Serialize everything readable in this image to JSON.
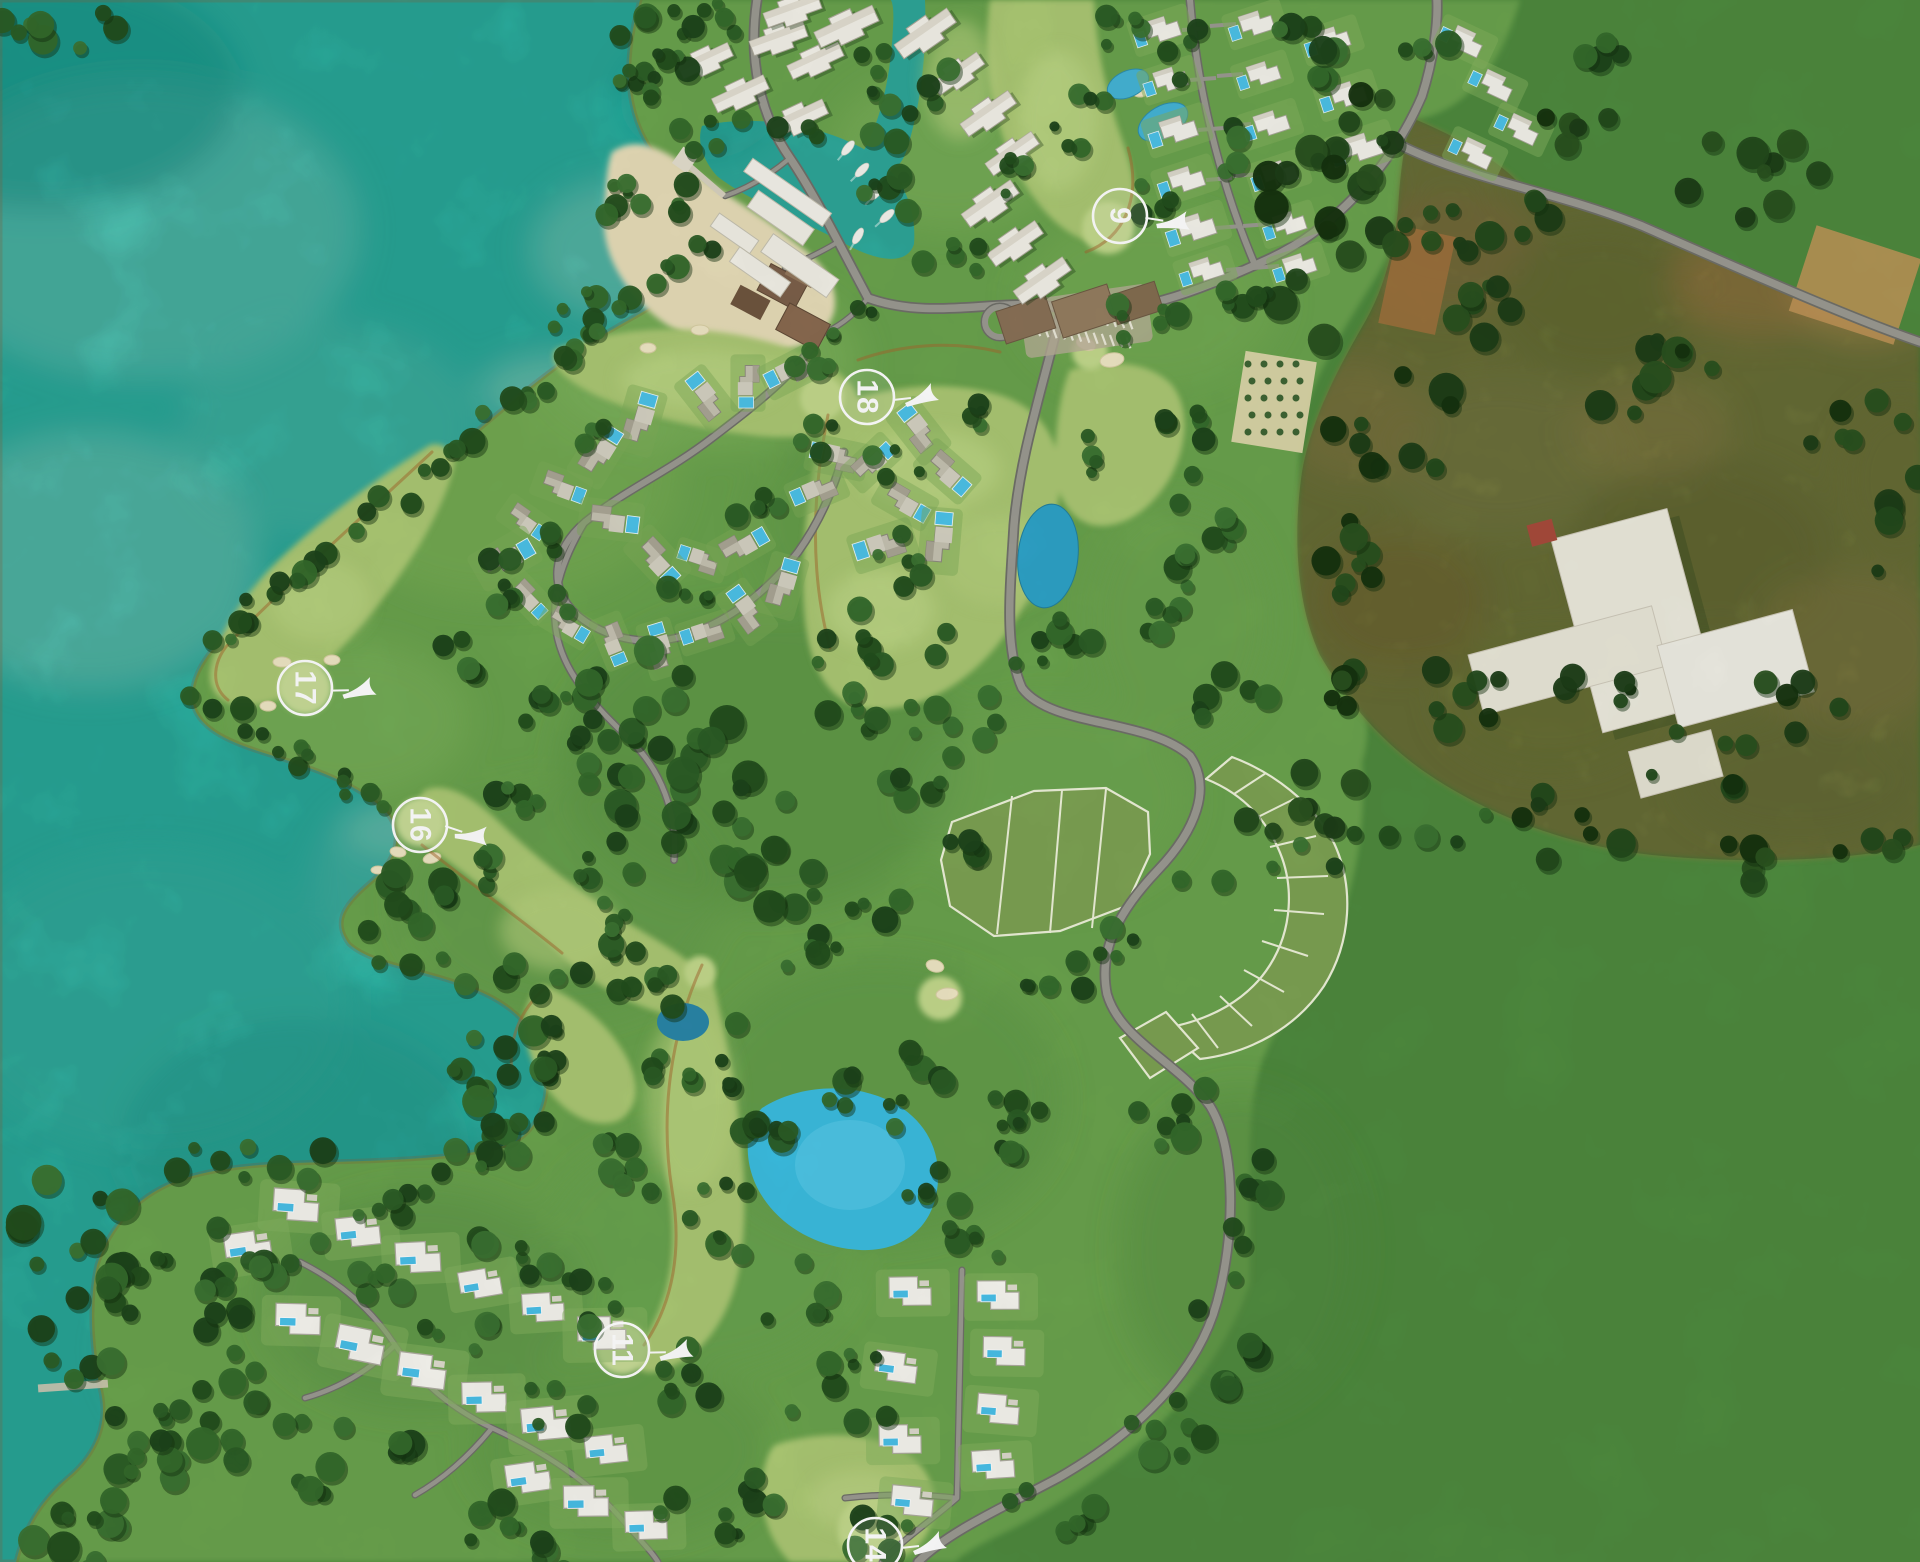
{
  "map": {
    "name": "golf-resort-master-plan-aerial-map",
    "hole_markers": [
      {
        "label": "9",
        "x": 1120,
        "y": 216,
        "arrow_rotation": 15
      },
      {
        "label": "18",
        "x": 867,
        "y": 397,
        "arrow_rotation": 0
      },
      {
        "label": "17",
        "x": 305,
        "y": 688,
        "arrow_rotation": 5
      },
      {
        "label": "16",
        "x": 420,
        "y": 825,
        "arrow_rotation": 25
      },
      {
        "label": "11",
        "x": 622,
        "y": 1350,
        "arrow_rotation": 5
      },
      {
        "label": "14",
        "x": 875,
        "y": 1545,
        "arrow_rotation": 0
      }
    ],
    "palette": {
      "lagoon": "#2fbfae",
      "lagoon_light": "#7fd7c6",
      "plan_land": "#6ba34e",
      "flat_green": "#4e8a3e",
      "fairway": "#abc873",
      "trees": "#2c5d26",
      "road": "#9b9a92",
      "sand": "#e7ddb8",
      "pool_blue": "#49c0e8",
      "farmland": "#7a8140",
      "building_white": "#f2f0e6"
    }
  }
}
